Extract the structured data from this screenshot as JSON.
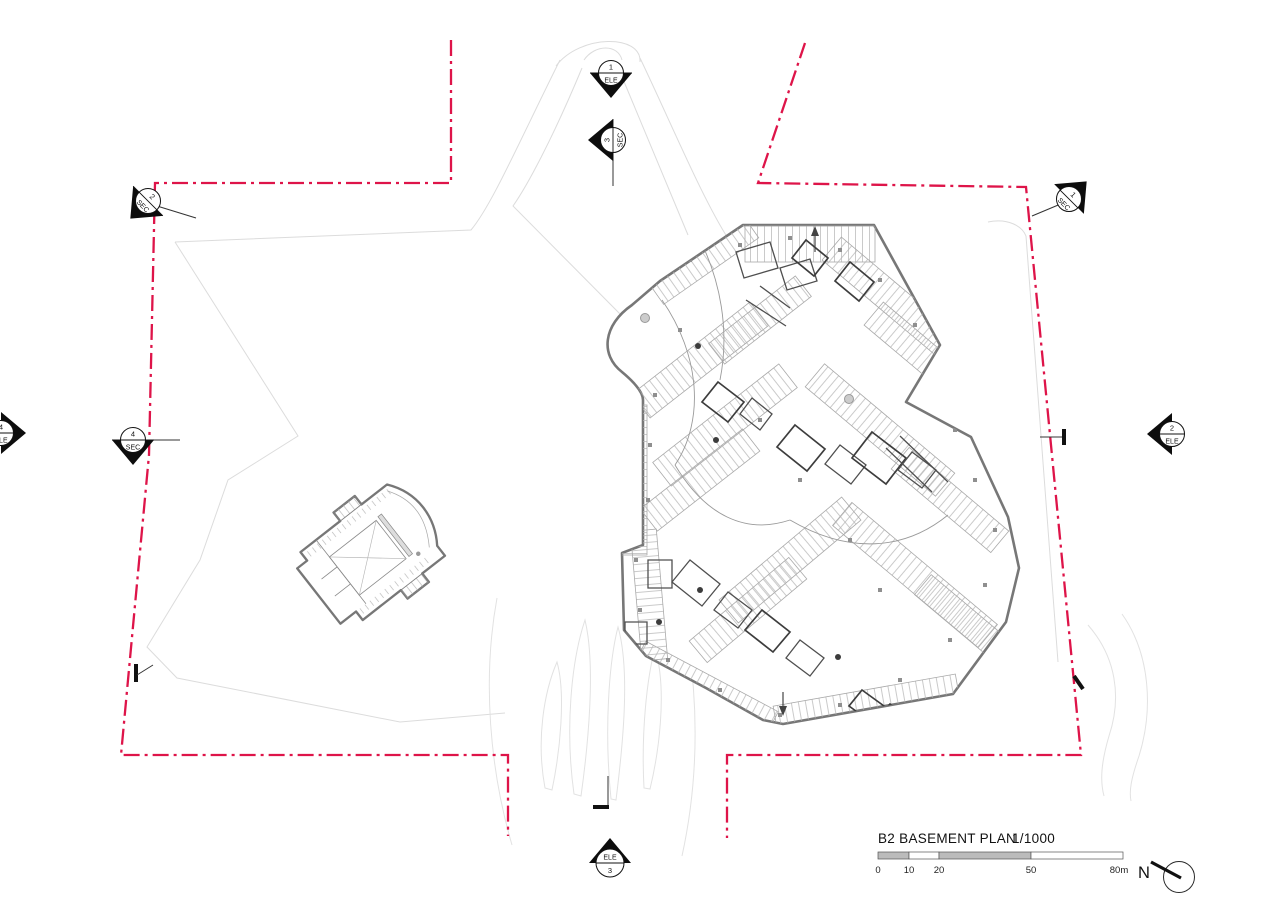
{
  "drawing": {
    "title": "B2 BASEMENT PLAN",
    "scale_ratio": "1/1000"
  },
  "scale_bar": {
    "tick_0": "0",
    "tick_10": "10",
    "tick_20": "20",
    "tick_50": "50",
    "tick_80": "80m"
  },
  "north": {
    "label": "N"
  },
  "markers": {
    "ele_1": {
      "number": "1",
      "label": "ELE"
    },
    "sec_3": {
      "number": "3",
      "label": "SEC"
    },
    "sec_2": {
      "number": "2",
      "label": "SEC"
    },
    "sec_1": {
      "number": "1",
      "label": "SEC"
    },
    "ele_4": {
      "number": "4",
      "label": "ELE"
    },
    "sec_4": {
      "number": "4",
      "label": "SEC"
    },
    "ele_2": {
      "number": "2",
      "label": "ELE"
    },
    "ele_3": {
      "number": "3",
      "label": "ELE"
    }
  },
  "colors": {
    "boundary_red": "#DE1449",
    "building_gray": "#777777",
    "site_line_gray": "#DCDCDC"
  }
}
